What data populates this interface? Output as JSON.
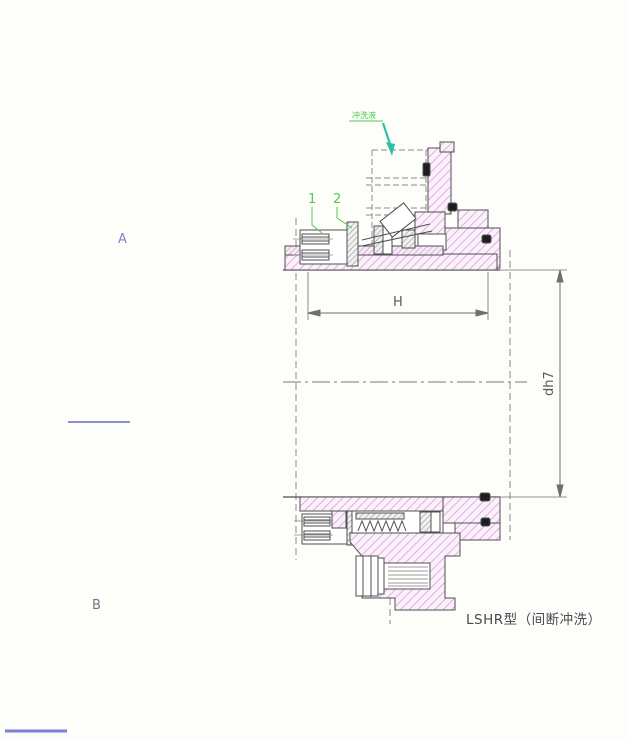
{
  "drawing": {
    "title": "LSHR型（间断冲洗）",
    "section_labels": {
      "a": "A",
      "b": "B"
    },
    "part_labels": {
      "part1": "1",
      "part2": "2"
    },
    "flush_label": "冲洗液",
    "dimensions": {
      "length": "H",
      "shaft_diameter": "dh7"
    }
  },
  "colors": {
    "hatch_pink": "#d897d8",
    "hatch_pink_bg": "#fbf1fa",
    "hatch_gray": "#8f8f8f",
    "outline": "#4f4f4f",
    "dim_line": "#6e6e6e",
    "green_label": "#4ec94e",
    "teal_arrow": "#2fc0a8",
    "blue_label": "#7b84c8",
    "blue_line": "#7b80d8",
    "o_ring": "#1e1e1e"
  }
}
